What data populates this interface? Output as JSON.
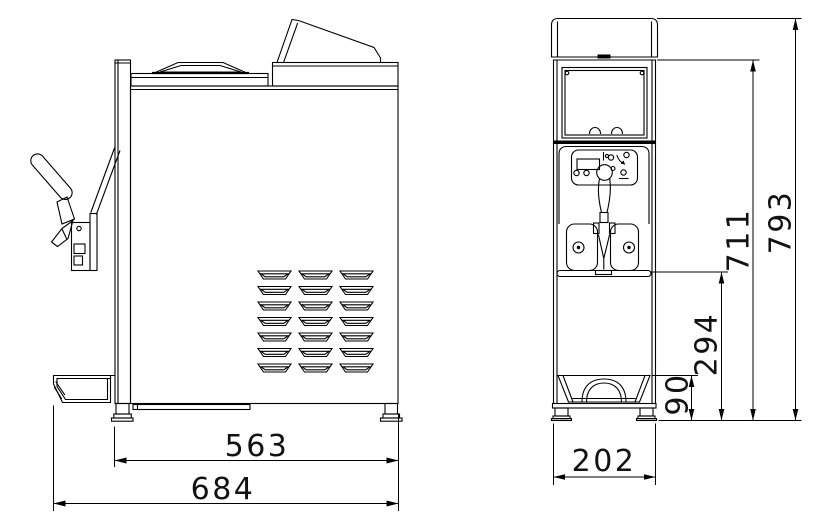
{
  "drawing": {
    "background_color": "#ffffff",
    "line_color": "#000000",
    "views": {
      "side_view": {
        "dimensions": {
          "body_depth": "563",
          "overall_depth": "684"
        }
      },
      "front_view": {
        "dimensions": {
          "tray_height": "90",
          "outlet_height": "294",
          "body_height": "711",
          "overall_height": "793",
          "overall_width": "202"
        }
      }
    }
  }
}
